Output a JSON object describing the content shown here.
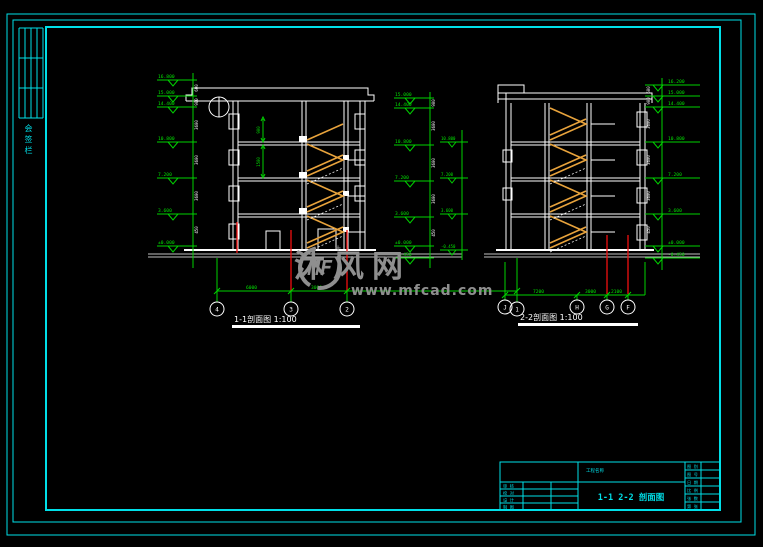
{
  "colors": {
    "background": "#000000",
    "frame": "#00dfe8",
    "cad_line": "#ffffff",
    "dimension": "#00d200",
    "axis_line": "#f01010",
    "stair": "#e8a33c",
    "watermark": "#8f8f8f"
  },
  "frame": {
    "side_label": "会签栏"
  },
  "watermark": {
    "logo_text": "MF",
    "brand": "沐风网",
    "url": "www.mfcad.com"
  },
  "section1": {
    "title": "1-1剖面图 1:100",
    "axes": [
      "4",
      "3",
      "2",
      "1"
    ],
    "span_dims": [
      "6000",
      "3000"
    ],
    "levels": [
      "16.800",
      "15.000",
      "14.400",
      "10.800",
      "7.200",
      "3.600",
      "±0.000"
    ],
    "seg_dims": [
      "600",
      "900",
      "3600",
      "3600",
      "3600",
      "450"
    ],
    "interior_dims": [
      "900",
      "1500"
    ]
  },
  "section2": {
    "title": "2-2剖面图 1:100",
    "axes": [
      "J",
      "H",
      "G",
      "F"
    ],
    "span_dims": [
      "7200",
      "3000",
      "2100"
    ],
    "left_levels": [
      "15.000",
      "14.400",
      "10.800",
      "7.200",
      "3.600",
      "±0.000",
      "-0.450"
    ],
    "right_levels": [
      "16.200",
      "15.000",
      "14.400",
      "10.800",
      "7.200",
      "3.600",
      "±0.000",
      "-0.450"
    ],
    "inner_levels": [
      "10.800",
      "7.200",
      "3.600",
      "-0.450"
    ],
    "left_seg_dims": [
      "900",
      "3600",
      "3600",
      "3600",
      "450"
    ],
    "right_seg_dims": [
      "600",
      "900",
      "3600",
      "3600",
      "3600",
      "450"
    ]
  },
  "titleblock": {
    "project_label": "工程名称",
    "main_title": "1-1  2-2  剖面图",
    "left_rows": [
      "审 核",
      "校 对",
      "设 计",
      "制 图"
    ],
    "right_rows": [
      "图 别",
      "图 号",
      "日 期",
      "比 例",
      "张 数",
      "第 张"
    ]
  }
}
